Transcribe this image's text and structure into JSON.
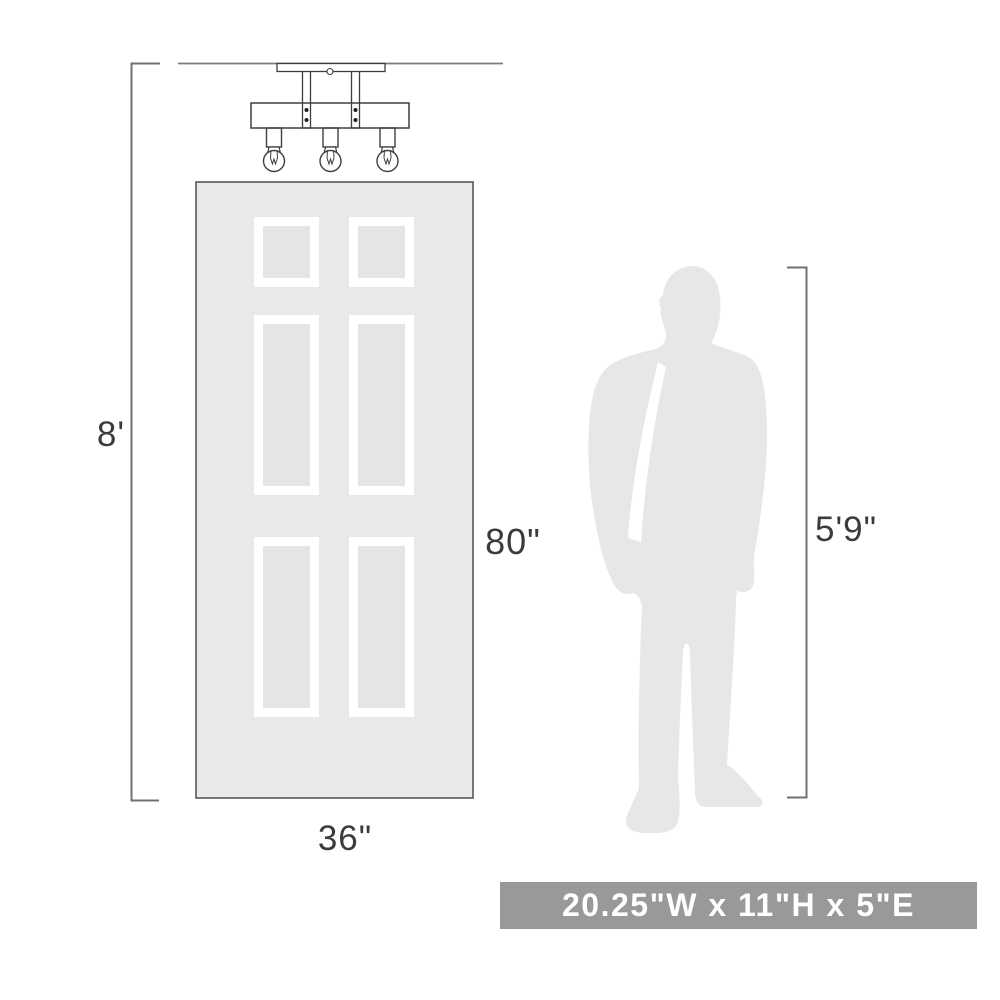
{
  "title": "Ceiling light fixture scale diagram",
  "dimensions": {
    "ceiling_height": "8'",
    "door_height": "80\"",
    "door_width": "36\"",
    "person_height": "5'9\""
  },
  "banner": {
    "text": "20.25\"W x 11\"H x 5\"E"
  },
  "colors": {
    "banner_bg": "#97999b",
    "banner_text": "#ffffff",
    "label_text": "#3b3b3d",
    "dimension_line": "#6f7072",
    "fixture_line": "#3e3e40",
    "door_fill": "#e9e9ea",
    "door_border": "#58585a",
    "door_panel_frame": "#ffffff",
    "door_panel_inner": "#e5e5e6",
    "person_fill": "#e7e7e9"
  },
  "scene": {
    "fixture": "3-light semi-flush ceiling fixture line drawing",
    "door": "six-panel door silhouette for scale",
    "person": "standing man silhouette for scale"
  }
}
